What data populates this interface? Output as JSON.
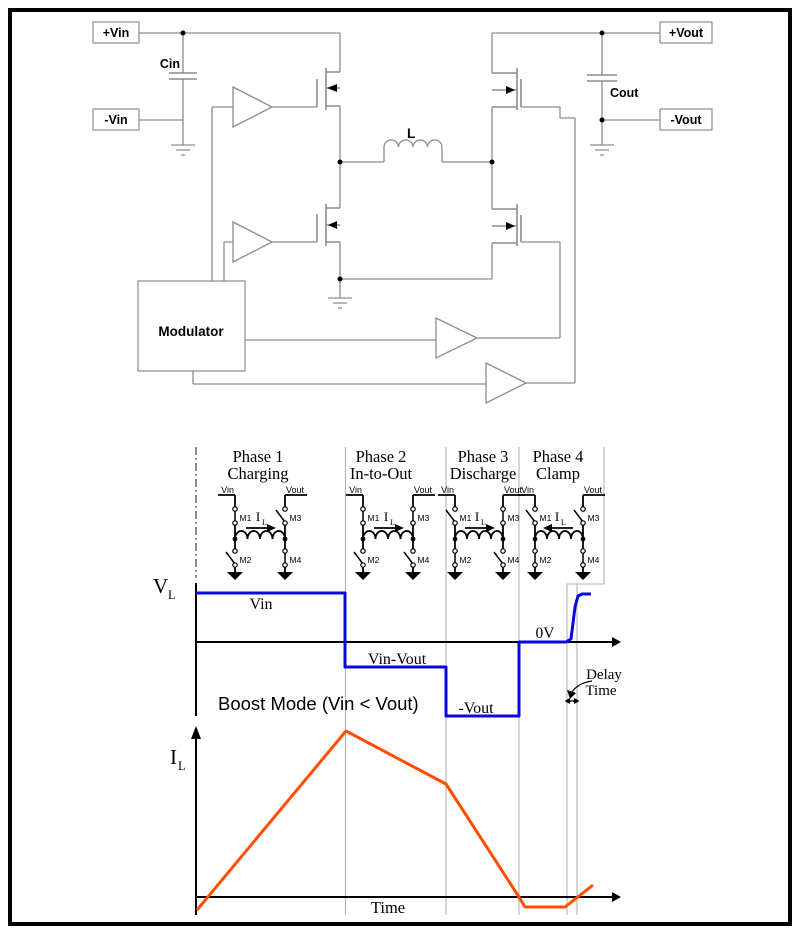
{
  "schematic": {
    "input_pos_label": "+Vin",
    "input_neg_label": "-Vin",
    "input_cap_label": "Cin",
    "output_pos_label": "+Vout",
    "output_neg_label": "-Vout",
    "output_cap_label": "Cout",
    "inductor_label": "L",
    "modulator_label": "Modulator"
  },
  "phases": [
    {
      "title": "Phase 1",
      "subtitle": "Charging",
      "vin_label": "Vin",
      "vout_label": "Vout",
      "switch_labels": {
        "m1": "M1",
        "m2": "M2",
        "m3": "M3",
        "m4": "M4"
      },
      "switch_states": {
        "m1": "closed",
        "m2": "open",
        "m3": "open",
        "m4": "closed"
      },
      "current_label": "I",
      "current_sub": "L",
      "current_direction": "right"
    },
    {
      "title": "Phase 2",
      "subtitle": "In-to-Out",
      "vin_label": "Vin",
      "vout_label": "Vout",
      "switch_labels": {
        "m1": "M1",
        "m2": "M2",
        "m3": "M3",
        "m4": "M4"
      },
      "switch_states": {
        "m1": "closed",
        "m2": "open",
        "m3": "closed",
        "m4": "open"
      },
      "current_label": "I",
      "current_sub": "L",
      "current_direction": "right"
    },
    {
      "title": "Phase 3",
      "subtitle": "Discharge",
      "vin_label": "Vin",
      "vout_label": "Vout",
      "switch_labels": {
        "m1": "M1",
        "m2": "M2",
        "m3": "M3",
        "m4": "M4"
      },
      "switch_states": {
        "m1": "open",
        "m2": "closed",
        "m3": "closed",
        "m4": "open"
      },
      "current_label": "I",
      "current_sub": "L",
      "current_direction": "right"
    },
    {
      "title": "Phase 4",
      "subtitle": "Clamp",
      "vin_label": "Vin",
      "vout_label": "Vout",
      "switch_labels": {
        "m1": "M1",
        "m2": "M2",
        "m3": "M3",
        "m4": "M4"
      },
      "switch_states": {
        "m1": "open",
        "m2": "closed",
        "m3": "open",
        "m4": "closed"
      },
      "current_label": "I",
      "current_sub": "L",
      "current_direction": "left"
    }
  ],
  "vl_plot": {
    "axis_symbol": "V",
    "axis_sub": "L",
    "level_vin": "Vin",
    "level_vin_minus_vout": "Vin-Vout",
    "level_neg_vout": "-Vout",
    "level_zero": "0V",
    "mode_text": "Boost Mode (Vin < Vout)",
    "delay_word1": "Delay",
    "delay_word2": "Time"
  },
  "il_plot": {
    "axis_symbol": "I",
    "axis_sub": "L",
    "time_label": "Time"
  },
  "waveforms": {
    "vl": {
      "color": "#0808e0",
      "points": [
        [
          196,
          593
        ],
        [
          345,
          593
        ],
        [
          345,
          667
        ],
        [
          446,
          667
        ],
        [
          446,
          716
        ],
        [
          519,
          716
        ],
        [
          519,
          642
        ],
        [
          566,
          642
        ],
        [
          571,
          639
        ],
        [
          575,
          607
        ],
        [
          578,
          596
        ],
        [
          582,
          594
        ],
        [
          591,
          594
        ]
      ]
    },
    "il": {
      "color": "#ff4e00",
      "points": [
        [
          197,
          910
        ],
        [
          346,
          731
        ],
        [
          446,
          784
        ],
        [
          519,
          897
        ],
        [
          525,
          907
        ],
        [
          565,
          907
        ],
        [
          593,
          885
        ]
      ]
    }
  },
  "colors": {
    "wire": "#8c8c8c",
    "divider": "#b3b3b3",
    "vl_trace": "#0808e0",
    "il_trace": "#ff4e00"
  }
}
